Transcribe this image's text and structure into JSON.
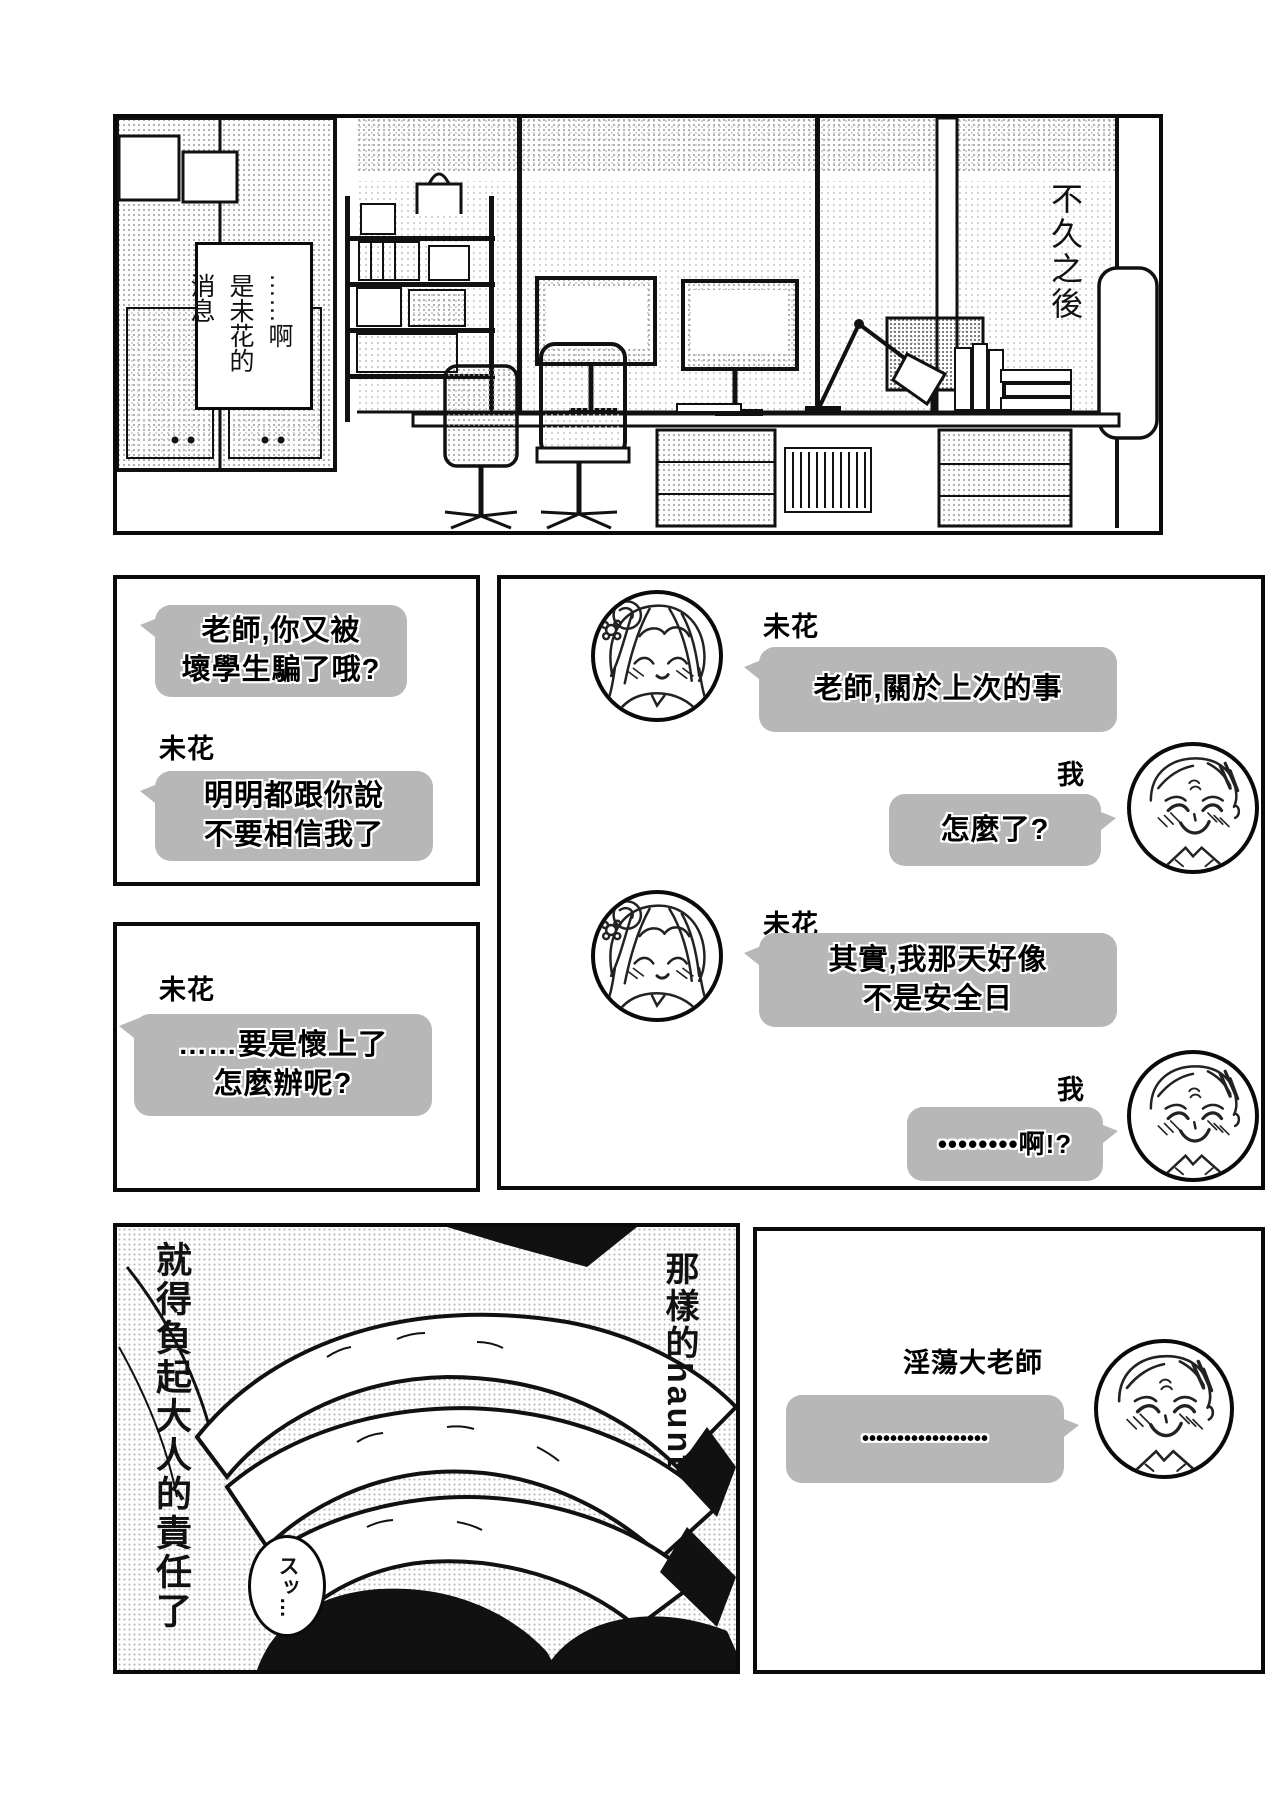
{
  "narration": {
    "soon_after": "不久之後",
    "caption": "……啊\n是未花的\n消息",
    "hand_panel_right": "那樣的haunt",
    "hand_panel_left": "就得負起大人的責任了",
    "sfx": "スッ…"
  },
  "chat": {
    "left_top": {
      "msg1": "老師,你又被\n壞學生騙了哦?",
      "sender2": "未花",
      "msg2": "明明都跟你說\n不要相信我了"
    },
    "left_bottom": {
      "sender": "未花",
      "msg": "……要是懷上了\n怎麼辦呢?"
    },
    "right": {
      "g1_sender": "未花",
      "g1_msg": "老師,關於上次的事",
      "g2_sender": "我",
      "g2_msg": "怎麼了?",
      "g3_sender": "未花",
      "g3_msg": "其實,我那天好像\n不是安全日",
      "g4_sender": "我",
      "g4_msg": "••••••••啊!?"
    },
    "bottom_right": {
      "sender": "淫蕩大老師",
      "msg": "••••••••••••••••••"
    }
  },
  "icons": {
    "girl_avatar": "mika-girl-face",
    "man_avatar": "teacher-man-face"
  },
  "colors": {
    "bubble_gray": "#b7b7b7",
    "ink": "#0a0a0a",
    "paper": "#ffffff"
  }
}
